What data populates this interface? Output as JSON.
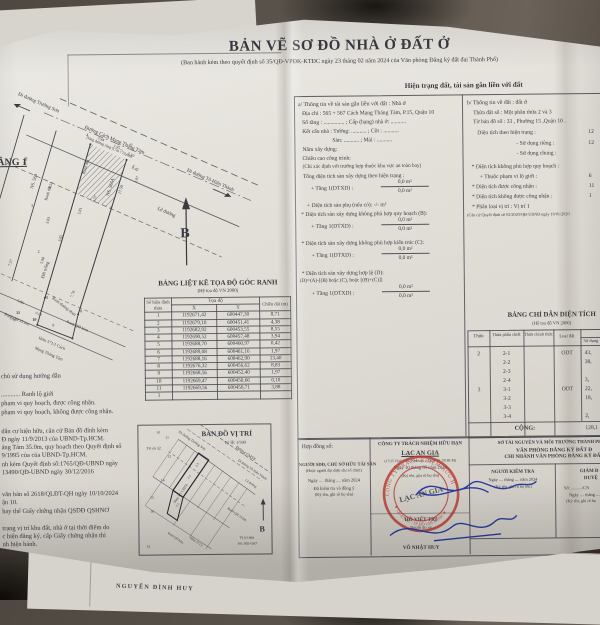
{
  "header": {
    "title": "BẢN VẼ SƠ ĐỒ NHÀ Ở ĐẤT Ở",
    "subtitle": "(Ban hành kèm theo quyết định số  35/QĐ-VPĐK-KTĐC ngày 23 tháng 02 năm  2024 của Văn phòng Đăng ký đất đai Thành Phố)"
  },
  "floor_plan": {
    "label": "TẦNG 1",
    "north_label": "B",
    "road_dir_left": "Đi đường Trường Sơn",
    "road_name": "Đường Cách Mạng Tháng Tám",
    "road_note": "(lòng đường rộng 9,7m - 10,0m)",
    "road_dir_right": "Đi đường Tô Hiến Thành",
    "sidewalk_label": "Lề đường",
    "house_left": "NS. 569",
    "house_right": "NS. 565A",
    "boundary_label_1": "Ranh đất",
    "boundary_label_2": "Ranh đất",
    "empty_land_label": "Đất trống",
    "asphalt_label": "Ranh đường nhựa",
    "planning_label": "Ranh QH 35.0m",
    "alley_planning_label": "Ranh QH hẻm",
    "alley_name_1": "Hẻm 571/1 Cách",
    "alley_name_2": "Mạng Tháng Tám",
    "dims": [
      "3.60",
      "3.94",
      "1.95",
      "3.10",
      "0.42",
      "17.50",
      "9.57",
      "8.55",
      "5.81",
      "3.83",
      "5.82",
      "5.90",
      "7.57",
      "7.76",
      "5.86",
      "0.10",
      "1.68",
      "1.97"
    ],
    "vertices": [
      "1",
      "2",
      "3",
      "4",
      "5",
      "6",
      "7",
      "8",
      "9",
      "10",
      "11"
    ]
  },
  "status_section": {
    "header": "Hiện trạng đất, tài sản gắn liền với đất",
    "a": {
      "heading": "a/ Thông tin về tài sản gắn liền với đất :  Nhà ở",
      "address": "Địa chỉ : 565 + 567 Cách Mạng Tháng Tám, P.15, Quận 10",
      "lines": [
        "Số tầng : ............... ; Cấp (hạng) nhà ở: ...........",
        "Kết cấu nhà :  Tường: ........... ; Cột : ...........",
        "Sàn: ........... ; Mái : ...........",
        "Năm xây dựng:",
        "Chiều cao công trình:",
        "(Chỉ xác định với trường hợp thuộc khu vực an toàn bay)",
        "Tổng diện tích sàn xây dựng theo hiện trạng :",
        "+ Tầng 1(DTXD) :",
        "+ Diện tích sàn phụ (nếu có):   -/-   m²",
        "* Diện tích sàn xây dựng không phù hợp quy hoạch (B):",
        "+ Tầng 1(DTXD) :",
        "* Diện tích sàn xây dựng không phù hợp kiến trúc (C):",
        "+ Tầng 1(DTXD) :",
        "* Diện tích sàn xây dựng hợp lệ (D):",
        "(D)=(A)-[(B) hoặc (C), hoặc [(B)+(C)]]",
        "+ Tầng 1(DTXD) :"
      ],
      "fraction_top": "0,0  m²",
      "fraction_bottom": "0,0  m²"
    },
    "b": {
      "heading": "b/ Thông tin về đất :  đất ở",
      "rows": [
        {
          "label": "Thửa đất số :    Một phần thửa 2 và 3",
          "value": ""
        },
        {
          "label": "Tờ bản đồ số : 33 , Phường  15  ,Quận 10  .",
          "value": ""
        },
        {
          "label": "Diện tích theo hiện trạng :",
          "value": "12"
        },
        {
          "label": "- Sử dụng riêng :",
          "value": "12"
        },
        {
          "label": "- Sử dụng chung :",
          "value": ""
        },
        {
          "label": "* Diện tích không phù hợp quy hoạch :",
          "value": ""
        },
        {
          "label": "+ Thuộc phạm vi lộ giới :",
          "value": "6"
        },
        {
          "label": "* Diện tích được công nhận :",
          "value": "11"
        },
        {
          "label": "* Diện tích không được công nhận :",
          "value": "1"
        },
        {
          "label": "* Phân loại vị trí :   Vị trí 1",
          "value": ""
        }
      ],
      "footnote": "(Căn cứ Quyết định số 02/2020/QĐ-UBND ngày 16/01/2020"
    }
  },
  "coord_table": {
    "title": "BẢNG LIỆT KÊ TỌA ĐỘ GÓC RANH",
    "subtitle": "(Hệ tọa độ VN 2000)",
    "col_vertex": "Số hiệu đỉnh thửa",
    "col_coords": "Tọa độ",
    "col_x": "X",
    "col_y": "Y",
    "col_len": "Chiều dài (m)",
    "rows": [
      [
        "1",
        "1192671,42",
        "600447,30",
        "8,71"
      ],
      [
        "2",
        "1192679,10",
        "600451,41",
        "4,38"
      ],
      [
        "3",
        "1192682,92",
        "600453,55",
        "8,55"
      ],
      [
        "4",
        "1192690,52",
        "600457,48",
        "3,94"
      ],
      [
        "5",
        "1192688,70",
        "600460,97",
        "0,42"
      ],
      [
        "6",
        "1192689,08",
        "600461,16",
        "1,97"
      ],
      [
        "7",
        "1192688,16",
        "600462,90",
        "13,40"
      ],
      [
        "8",
        "1192676,32",
        "600456,62",
        "8,83"
      ],
      [
        "9",
        "1192668,56",
        "600452,40",
        "1,97"
      ],
      [
        "10",
        "1192669,47",
        "600450,66",
        "0,10"
      ],
      [
        "11",
        "1192669,56",
        "600450,71",
        "3,88"
      ],
      [
        "1",
        "",
        "",
        ""
      ]
    ]
  },
  "area_table": {
    "title": "BẢNG CHỈ DẪN DIỆN TÍCH",
    "subtitle": "(Hệ tọa độ VN 2000)",
    "col_parcel": "Thửa",
    "col_sub": "Thửa phân chiết",
    "col_official": "Thửa chính thức",
    "col_type": "Loại đất",
    "col_area": "Diện tích",
    "col_use": "Sử dụng",
    "rows": [
      {
        "parcel": "2",
        "sub": "2-1",
        "official": "",
        "type": "ODT",
        "use": "43,"
      },
      {
        "parcel": "",
        "sub": "2-2",
        "official": "",
        "type": "",
        "use": "38,"
      },
      {
        "parcel": "",
        "sub": "2-3",
        "official": "",
        "type": "",
        "use": ""
      },
      {
        "parcel": "",
        "sub": "2-4",
        "official": "",
        "type": "",
        "use": "3,"
      },
      {
        "parcel": "3",
        "sub": "3-1",
        "official": "",
        "type": "ODT",
        "use": "22,"
      },
      {
        "parcel": "",
        "sub": "3-2",
        "official": "",
        "type": "",
        "use": "18,"
      },
      {
        "parcel": "",
        "sub": "3-3",
        "official": "",
        "type": "",
        "use": ""
      },
      {
        "parcel": "",
        "sub": "3-4",
        "official": "",
        "type": "",
        "use": "2,"
      }
    ],
    "total_label": "CỘNG:",
    "total_value": "128,1"
  },
  "notes": {
    "lines": [
      "chủ sử dụng hướng dẫn",
      "............    Ranh lộ giới",
      "phạm vi quy hoạch, được công nhận.",
      "phạm vi quy hoạch, không được công nhận.",
      "dân cư hiện hữu, căn cứ Bản đồ đính kèm",
      "Đ ngày 11/9/2013 của UBND-Tp.HCM.",
      "áng Tám 35.0m, quy hoạch theo Quyết định số",
      "9/1995 của của UBND-Tp.HCM.",
      "nh kèm Quyết định số:1765/QĐ-UBND ngày",
      "13490/QĐ-UBND ngày 30/12/2016",
      "văn bản số 2618/QLĐT-QH ngày 10/10/2024",
      "ận 10.",
      "hay thế Giấy chứng nhận QSDĐ QSHNƠ",
      "trạng vị trí khu đất, nhà ở tại thời điểm do",
      "c hiện đăng ký, cấp Giấy chứng nhận thì",
      "nh hiện hành."
    ]
  },
  "location_map": {
    "title": "BẢN ĐỒ VỊ TRÍ",
    "scale": "Tỷ lệ: 1/500",
    "sheet_label": "Tờ số 32",
    "road_dir_left": "Đi đường Trường Sơn",
    "road_name": "Đường CMT8",
    "road_dir_right": "Đi đường Tô Hiến Thành",
    "sidewalk": "Lề đường",
    "alley_1": "Hẻm 571 CMT8",
    "alley_2": "Hẻm 571/1",
    "planning": "Ranh QH 35.0m",
    "alley_planning": "Ranh QH hẻm",
    "position_label": "Vị trí nhà",
    "position_number": "Số: 565+567",
    "north_label": "B",
    "lots": [
      "10",
      "11",
      "12",
      "14",
      "15",
      "16",
      "32"
    ],
    "sublots": [
      "2-1",
      "2-3",
      "3-2"
    ]
  },
  "approval": {
    "contract_label": "Hợp đồng số:",
    "owner_title": "NGƯỜI SDĐ, CHỦ SỞ HỮU TÀI SẢN",
    "owner_sub": "(Hoặc người đại diện cho tổ chức)",
    "owner_date": "Ngày .... tháng .... năm 2024",
    "owner_agree": "Đã kiểm tra và đồng ý",
    "owner_sign": "(Ký tên, ghi rõ họ tên)",
    "company_type": "CÔNG TY TRÁCH NHIỆM HỮU HẠN",
    "company_name": "LẠC AN GIA",
    "company_address": "(17/25 Vĩnh Viễn, Phường ..., Quận 10, TP.HCM)",
    "company_date": "Ngày 10 tháng 09 năm 2024",
    "company_sign": "(Ký tên, ghi rõ họ tên)",
    "surveyor_name": "HỒ VIẾT TRÍ",
    "surveyor_role": "Người đo vẽ",
    "drafter_name": "VÕ NHẬT HUY",
    "dept_line1": "SỞ TÀI NGUYÊN VÀ MÔI TRƯỜNG THÀNH PHỐ H",
    "dept_line2": "VĂN PHÒNG ĐĂNG KÝ ĐẤT Đ",
    "dept_line3": "CHI NHÁNH VĂN PHÒNG ĐĂNG KÝ ĐẤT",
    "checker_title": "NGƯỜI KIỂM TRA",
    "checker_date": "Ngày .... tháng .... năm 2024",
    "checker_sign": "(Ký tên, ghi rõ họ tên)",
    "director_line1": "GIÁM Đ",
    "director_line2": "DUYỆ",
    "director_no": "Số: ........../CN",
    "director_date": "Ngày .... tháng ....",
    "director_sign": "(Ký tên, ghi rõ họ"
  },
  "stamp": {
    "ring_top": "CÔNG TY TRÁCH NHIỆM HỮU HẠN",
    "ring_bottom": "★ QUẬN 10 - TP HỒ CHÍ MINH ★",
    "center": "LẠC AN GIA",
    "color": "#b63a31"
  },
  "signature_blue": "#2a3c9e",
  "under_sheet": {
    "name": "NGUYỄN ĐÌNH HUY"
  }
}
